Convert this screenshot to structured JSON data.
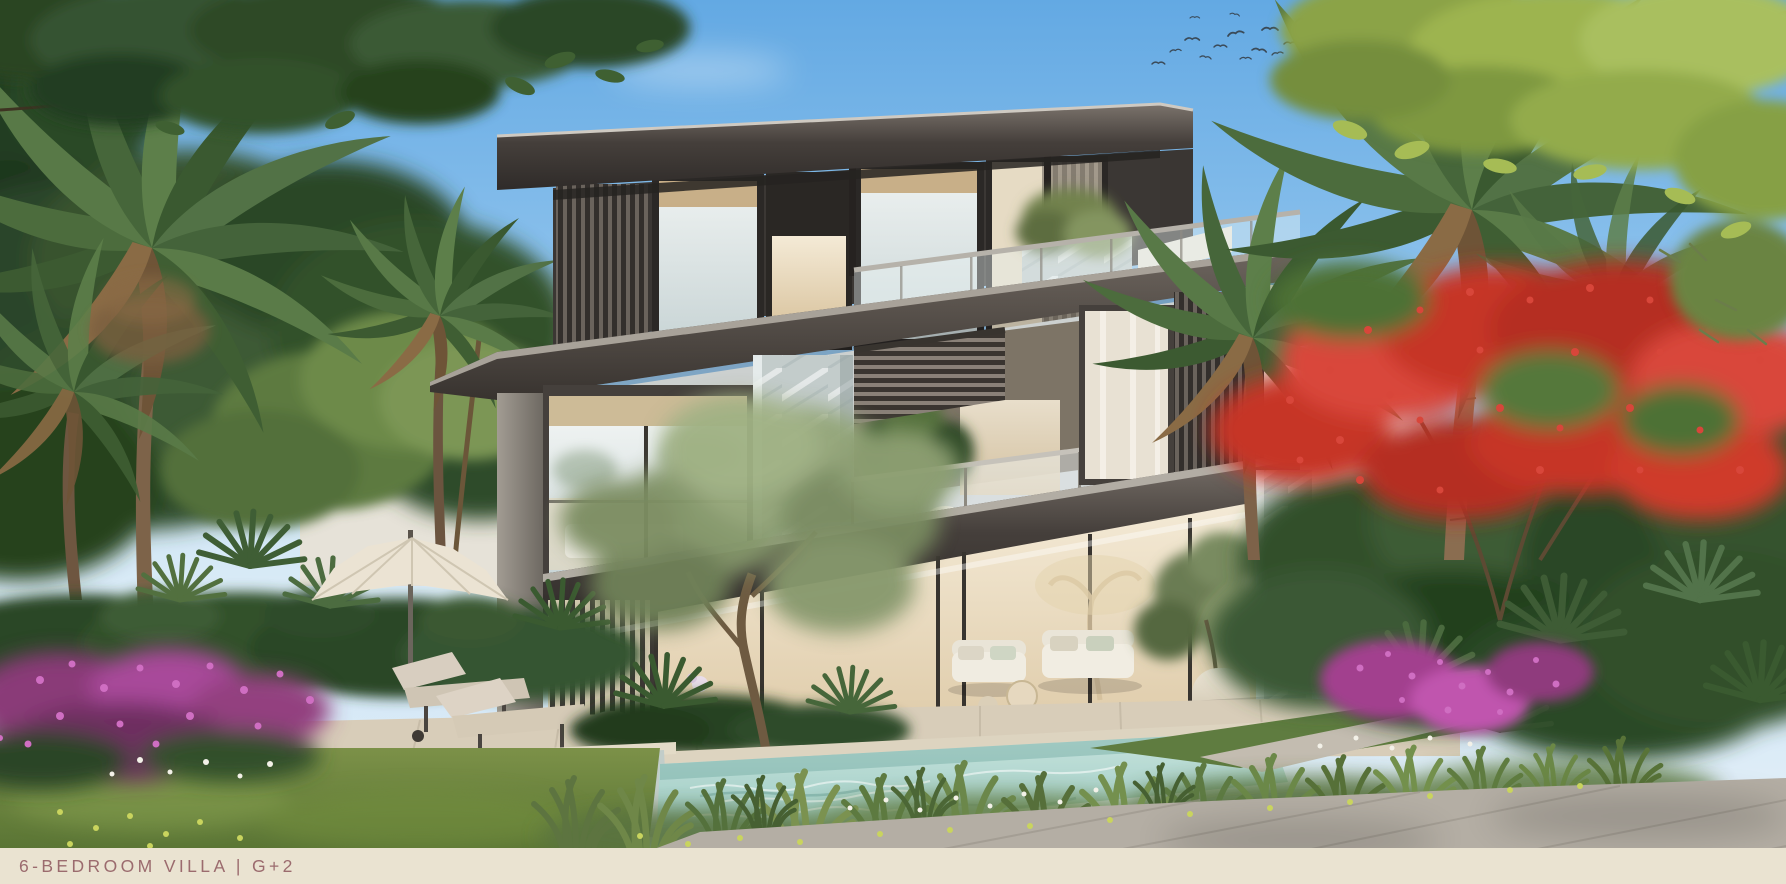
{
  "meta": {
    "type": "architectural-rendering",
    "description": "Rear garden view of a modern three-storey luxury villa with bronze fascias, marble columns, glass balustrades, an infinity pool, sun loungers, a parasol, palm trees, a red flame tree and tropical flowering landscaping under a blue sky with a flock of birds."
  },
  "caption": {
    "text": "6-BEDROOM VILLA | G+2"
  },
  "palette": {
    "sky_top": "#63a9e3",
    "sky_horizon": "#e8f2f8",
    "roof_bronze": "#45403b",
    "facade_glass": "#dde6e6",
    "interior_warm": "#efe3c9",
    "marble": "#c3cccb",
    "terrace_stone": "#d8cdb9",
    "paver_grey": "#b4aea4",
    "pool_water": "#9fd0c7",
    "lawn_green": "#6d8842",
    "foliage_dark": "#2c4627",
    "foliage_light": "#8fae62",
    "flower_red": "#d8463a",
    "flower_magenta": "#cf6ec2",
    "flower_yellow": "#c9d45e",
    "flower_white": "#f3f1e8",
    "umbrella_canvas": "#ebe3d3",
    "lounger_beige": "#d5cab6",
    "caption_bar": "#eae3d1",
    "caption_text": "#9b6b6e"
  },
  "scene": {
    "elements": [
      "sky",
      "clouds",
      "bird-flock",
      "overhanging-branches",
      "left-palm-trees",
      "left-garden-hedge",
      "patio-umbrella",
      "sun-loungers",
      "villa",
      "roof-slab",
      "upper-floor-windows",
      "roof-terrace-railing",
      "mid-fascia",
      "first-floor-balcony",
      "pergola-louvers",
      "marble-columns",
      "ground-floor-glazing",
      "outdoor-sofa-set",
      "olive-tree",
      "terrace-steps",
      "swimming-pool",
      "ornamental-grasses",
      "flower-beds",
      "right-tropical-garden",
      "flame-tree",
      "right-palm-trees",
      "paver-path",
      "caption-bar"
    ]
  }
}
